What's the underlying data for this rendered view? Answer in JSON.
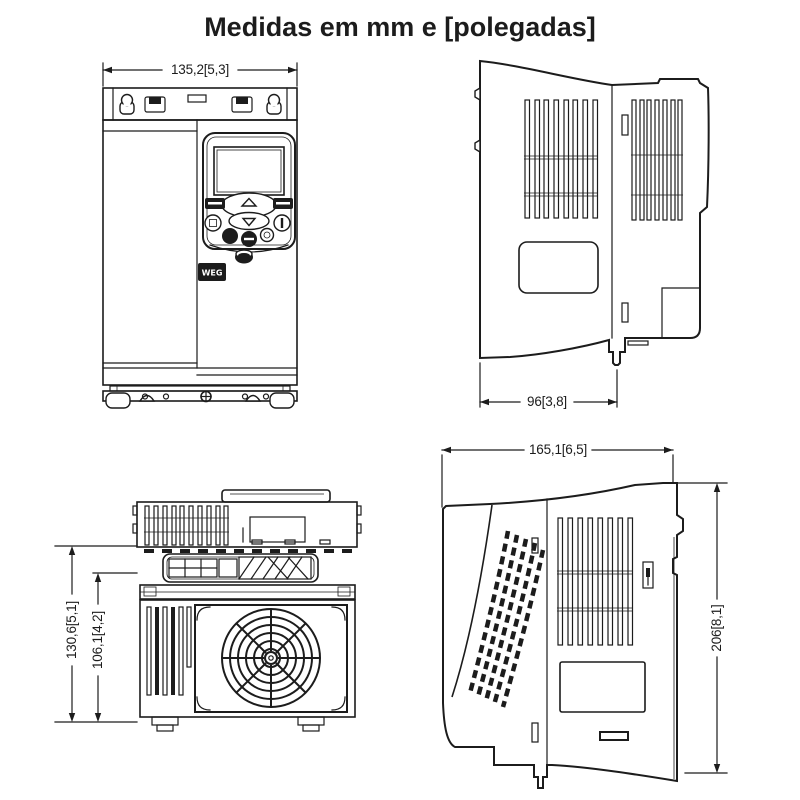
{
  "page": {
    "title": "Medidas em mm e [polegadas]"
  },
  "drawing": {
    "front_view": {
      "width_dim": "135,2[5,3]",
      "logo": "WEG"
    },
    "right_side_view": {
      "depth_dim": "96[3,8]"
    },
    "top_view": {
      "outer_dim": "130,6[5,1]",
      "inner_dim": "106,1[4,2]"
    },
    "left_side_view": {
      "depth_dim": "165,1[6,5]",
      "height_dim": "206[8,1]"
    }
  },
  "colors": {
    "line": "#1c1c1c",
    "background": "#ffffff"
  }
}
